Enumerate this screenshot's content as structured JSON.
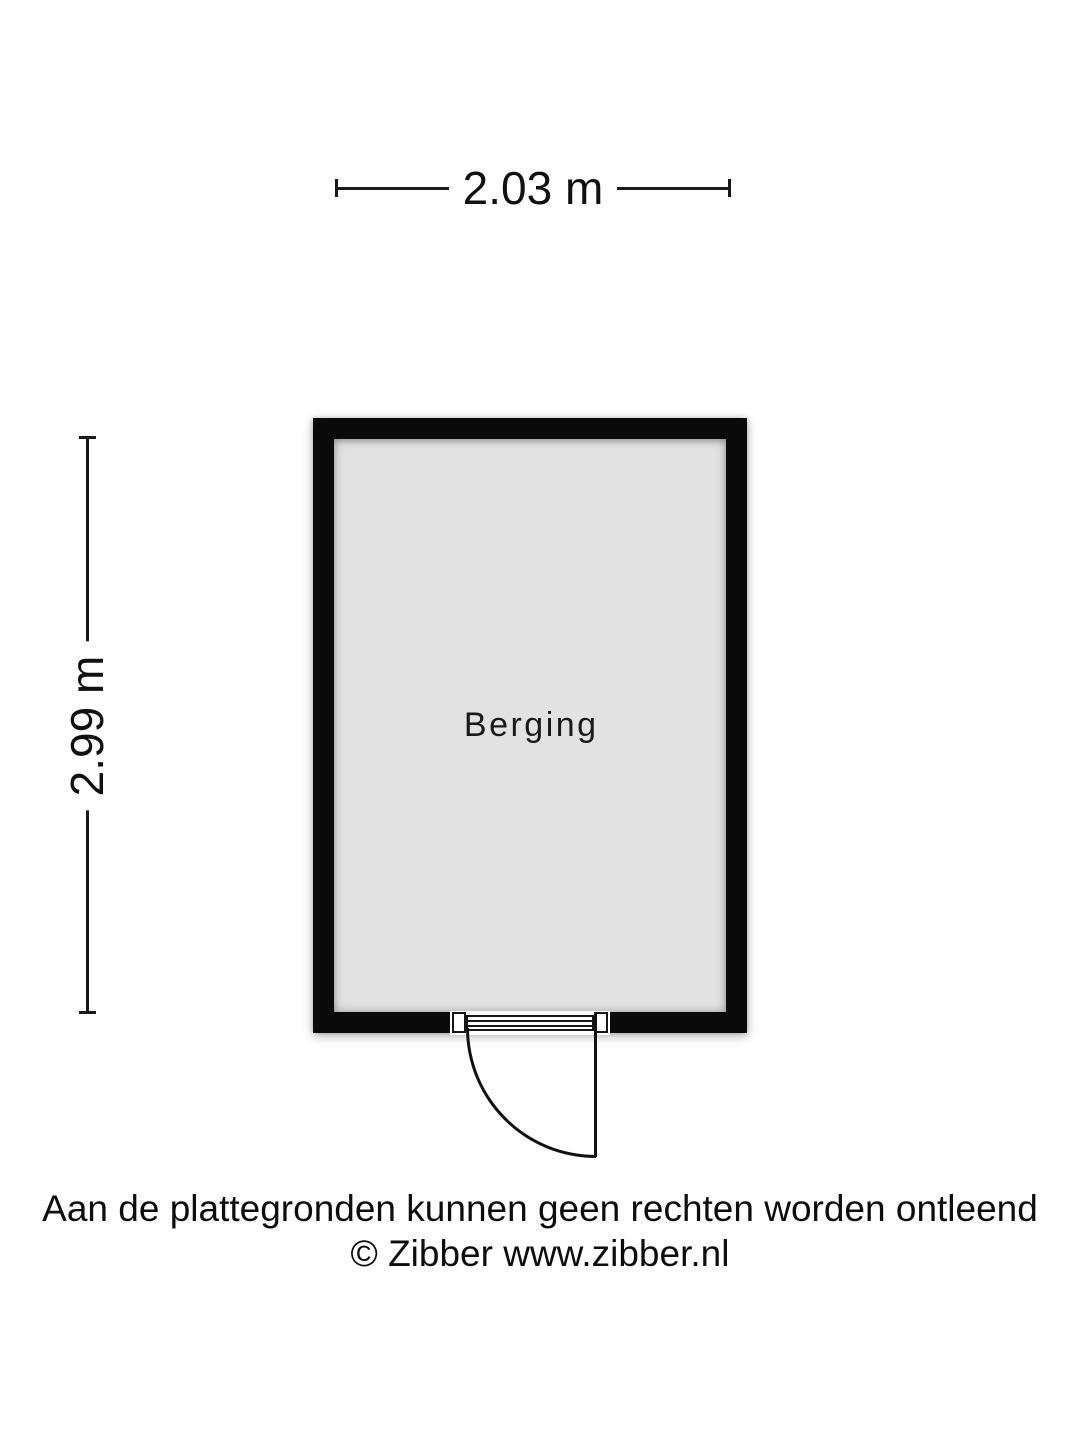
{
  "colors": {
    "background": "#ffffff",
    "wall": "#0a0a0a",
    "floor": "#e2e2e2",
    "line": "#1a1a1a",
    "text": "#111111"
  },
  "icons": {
    "door": "hinged-door-swing"
  },
  "floorplan": {
    "room_label": "Berging",
    "width_dimension": "2.03 m",
    "height_dimension": "2.99 m"
  },
  "footer": {
    "disclaimer": "Aan de plattegronden kunnen geen rechten worden ontleend",
    "copyright": "© Zibber www.zibber.nl"
  }
}
